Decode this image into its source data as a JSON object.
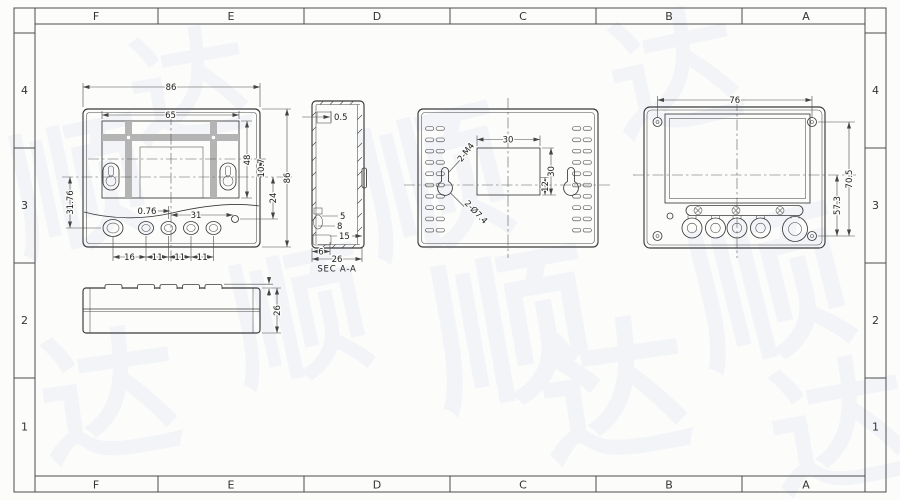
{
  "frame": {
    "cols": [
      "F",
      "E",
      "D",
      "C",
      "B",
      "A"
    ],
    "rows": [
      "4",
      "3",
      "2",
      "1"
    ]
  },
  "front_view": {
    "dim_width_outer": "86",
    "dim_width_inner": "65",
    "dim_display_height": "48",
    "dim_center_offset": "10.7",
    "dim_height_outer": "86",
    "dim_led_drop": "24",
    "dim_left_height": "31.76",
    "dim_button_offset": "0.76",
    "dim_led_offset": "31",
    "spacings": [
      "16",
      "11",
      "11",
      "11"
    ]
  },
  "bottom_view": {
    "dim_height": "26"
  },
  "section_view": {
    "title": "SEC A-A",
    "dim_wall": "0.5",
    "dim_a": "5",
    "dim_b": "8",
    "dim_c": "15",
    "dim_d": "6",
    "dim_depth": "26"
  },
  "back_view": {
    "dim_cutout_width": "30",
    "dim_cutout_height": "30",
    "dim_offset": "12",
    "callout_screws": "2-M4",
    "callout_holes": "2-Ø7.4"
  },
  "terminal_view": {
    "dim_width": "76",
    "dim_height_a": "70.5",
    "dim_height_b": "57.3"
  },
  "watermark": {
    "chars": [
      "顺",
      "达"
    ]
  }
}
